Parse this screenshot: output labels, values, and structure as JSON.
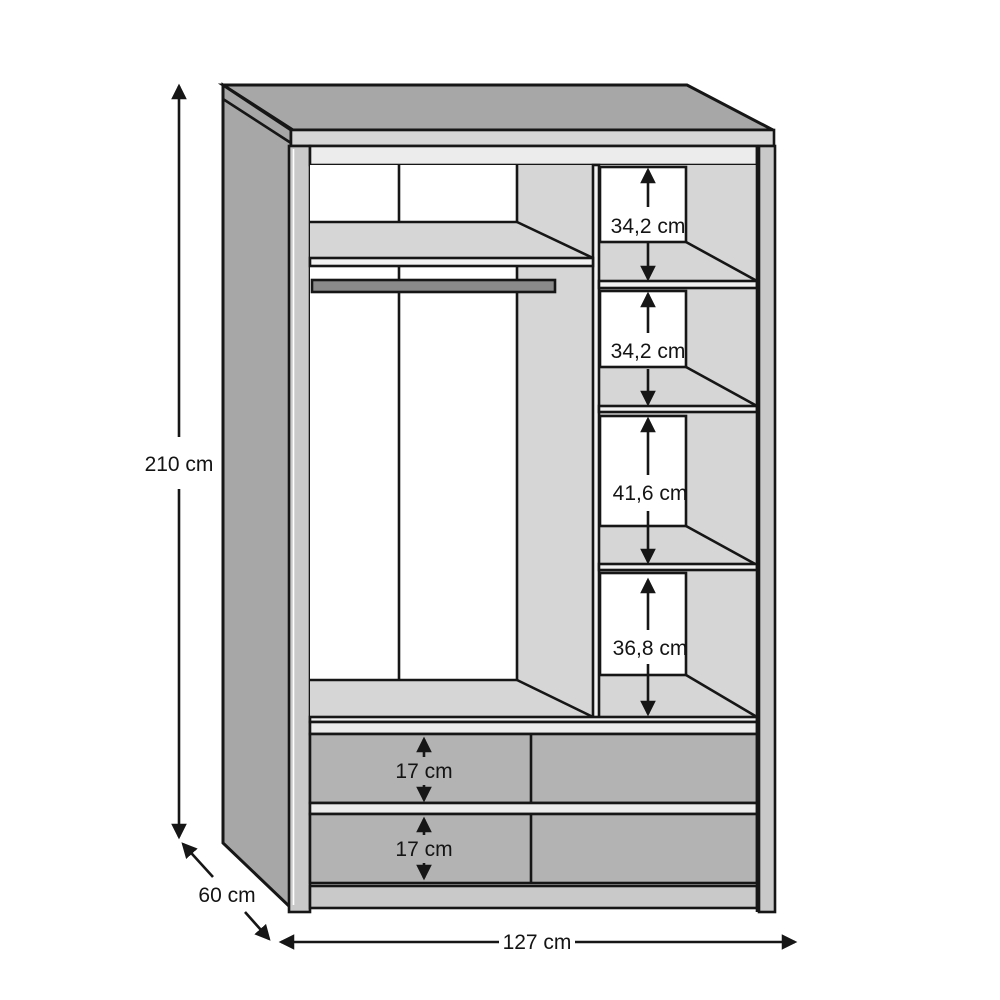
{
  "dimensions": {
    "height": "210 cm",
    "width": "127 cm",
    "depth": "60 cm",
    "compartments": [
      "34,2 cm",
      "34,2 cm",
      "41,6 cm",
      "36,8 cm"
    ],
    "drawers": [
      "17 cm",
      "17 cm"
    ]
  },
  "colors": {
    "outline": "#161616",
    "carcass": "#a7a7a7",
    "shelf_surface": "#d6d6d6",
    "inner_band": "#ececec",
    "edge_highlight": "#f2f2f2",
    "drawer_front": "#b3b3b3",
    "frame_stile": "#c9c9c9",
    "hanging_rail": "#8a8a8a",
    "background": "#ffffff"
  }
}
